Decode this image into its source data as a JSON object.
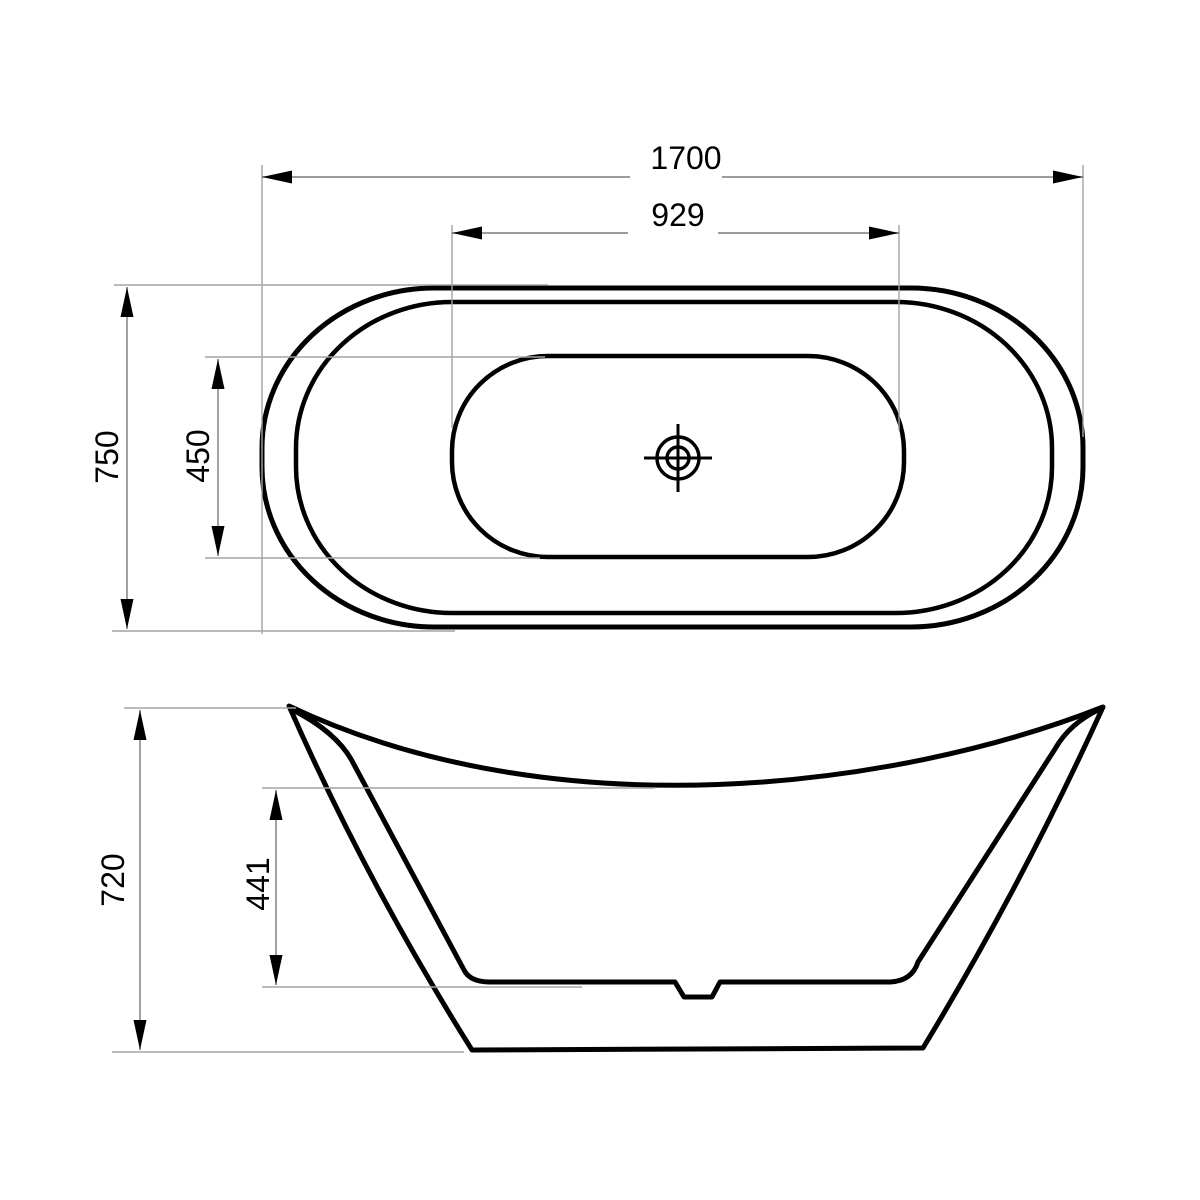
{
  "colors": {
    "background": "#ffffff",
    "outline": "#000000",
    "dimension_line": "#7a7a7a",
    "extension_line": "#a3a3a3",
    "arrow": "#000000",
    "text": "#000000"
  },
  "top_view": {
    "dim_overall_length": "1700",
    "dim_basin_length": "929",
    "dim_overall_width": "750",
    "dim_basin_width": "450",
    "drain_symbol": "crosshair-target"
  },
  "side_view": {
    "dim_overall_height": "720",
    "dim_inner_depth": "441"
  }
}
